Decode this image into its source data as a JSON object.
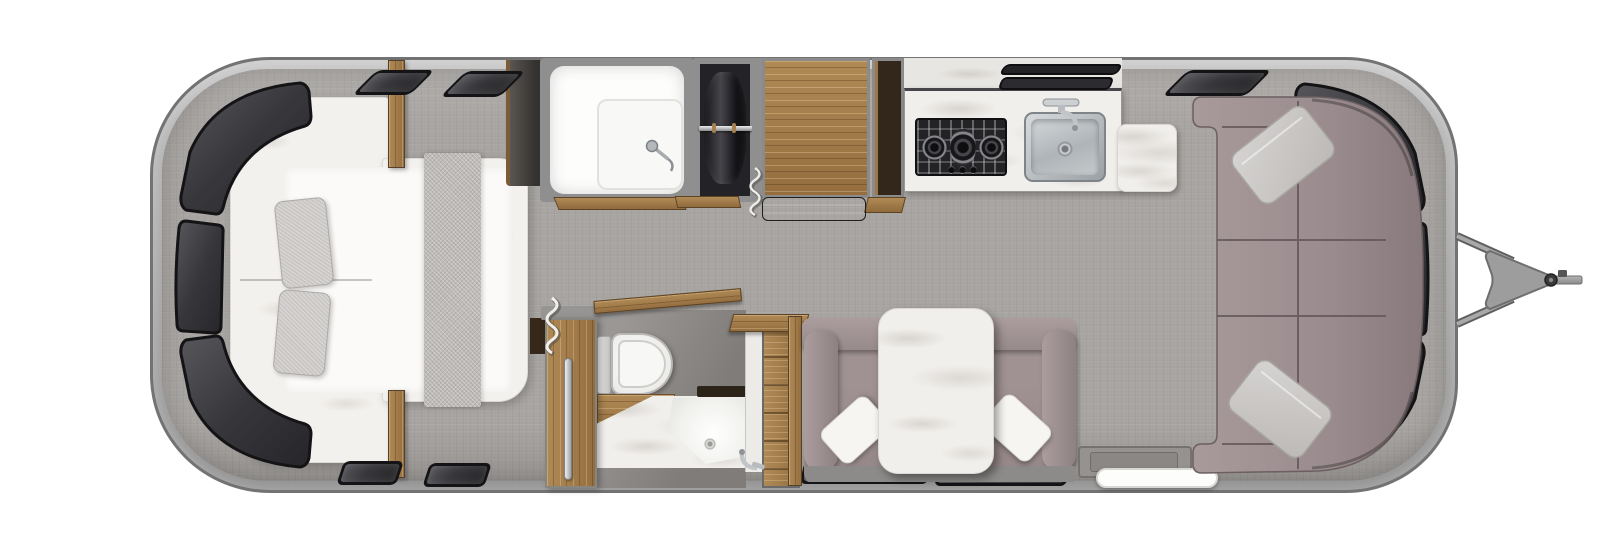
{
  "meta": {
    "title": "Travel trailer floor plan — top-down rendering"
  },
  "palette": {
    "page_bg": "#ffffff",
    "shell_outline": "#737373",
    "shell_light": "#c9c9c9",
    "shell_mid": "#a6a6a6",
    "floor": "#a8a5a2",
    "wall_gray": "#8f8f8f",
    "window_fill": "#37373b",
    "window_frame": "#141416",
    "wood_light": "#b08a55",
    "wood_mid": "#946e3f",
    "wood_edge": "#5e4526",
    "wood_deep": "#33261a",
    "upholstery": "#9e9192",
    "upholstery_deep": "#6b5f61",
    "cushion_gray": "#c9c6c4",
    "linen": "#f3f1ee",
    "sheet": "#fbfaf8",
    "runner": "#bdbab7",
    "marble": "#f1efec",
    "marble_dim": "#e8e6e2",
    "steel_light": "#d7dadc",
    "steel_dark": "#8e9497",
    "cooktop_black": "#232325"
  },
  "components": {
    "trailer": {
      "label": "Travel trailer shell, top-down view"
    },
    "bed": {
      "label": "Rear bedroom queen bed with pillows and runner"
    },
    "rear_windows": {
      "label": "Curved rear wraparound windows"
    },
    "shower": {
      "label": "Shower with glass enclosure and wand"
    },
    "wardrobe": {
      "label": "Wardrobe with hanging clothes"
    },
    "dresser": {
      "label": "Wood dresser cabinet"
    },
    "pantry": {
      "label": "Tall pantry cabinet"
    },
    "kitchen_counter": {
      "label": "Kitchen counter with marble top"
    },
    "cooktop": {
      "label": "Three-burner gas cooktop"
    },
    "sink": {
      "label": "Stainless steel kitchen sink with faucet"
    },
    "side_table": {
      "label": "Marble side table"
    },
    "bathroom": {
      "label": "Bathroom with toilet and corner vanity"
    },
    "toilet": {
      "label": "Toilet"
    },
    "vanity_sink": {
      "label": "Corner vanity sink with faucet"
    },
    "bath_door": {
      "label": "Bathroom wood door with handle"
    },
    "dinette": {
      "label": "Dinette with marble table and bench seating"
    },
    "sofa": {
      "label": "Front wraparound lounge sofa with throw pillows"
    },
    "front_windows": {
      "label": "Curved front wraparound windows"
    },
    "entry_step": {
      "label": "Entry door step and grab handle"
    },
    "hitch": {
      "label": "A-frame tow hitch and coupler"
    },
    "windows_side": {
      "label": "Tinted side windows"
    }
  }
}
